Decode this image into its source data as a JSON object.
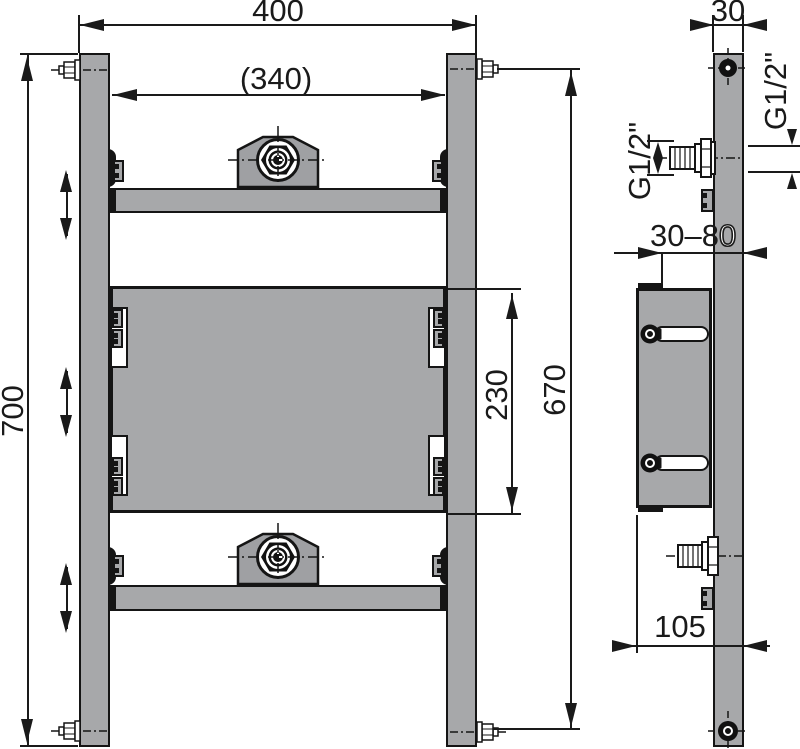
{
  "dimensions": {
    "front": {
      "overall_width": "400",
      "inner_width": "(340)",
      "overall_height": "700",
      "mount_bolt_span": "670",
      "plate_height": "230"
    },
    "side": {
      "profile_depth": "30",
      "thread_left": "G1/2\"",
      "thread_right": "G1/2\"",
      "wall_distance_main": "30–8",
      "wall_distance_overlap": "0",
      "base_depth": "105"
    }
  },
  "colors": {
    "metal": "#a7a8aa",
    "line": "#1a1a1a",
    "background": "#ffffff"
  }
}
